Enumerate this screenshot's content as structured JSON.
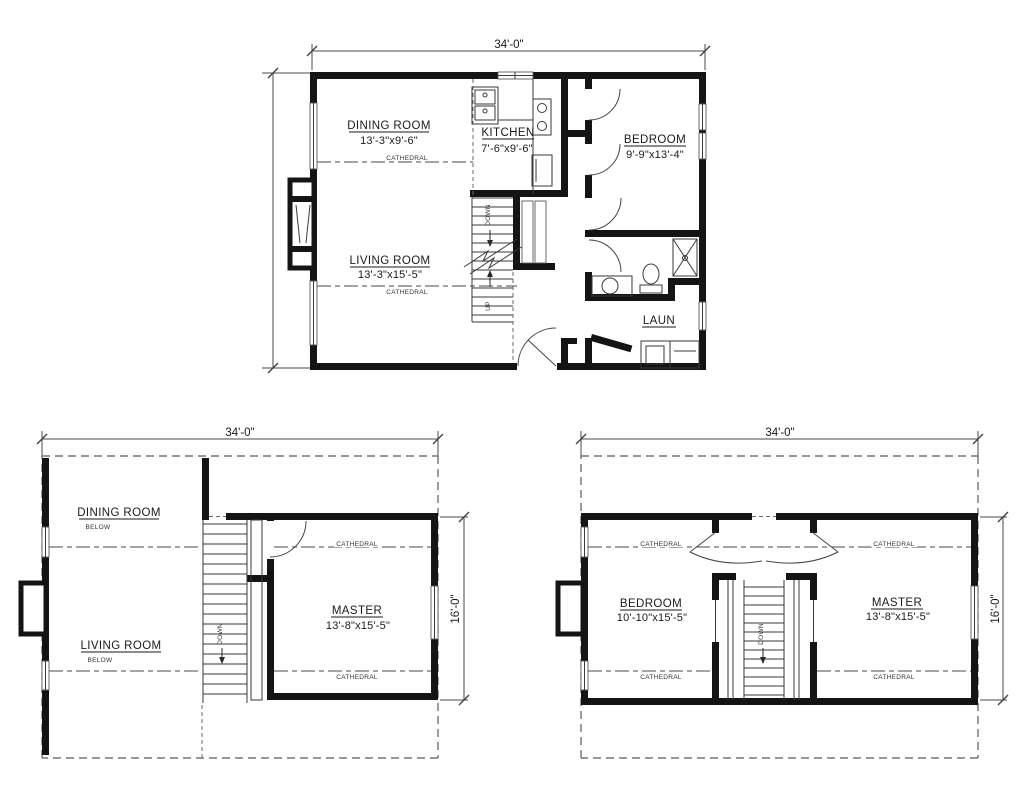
{
  "sheet": {
    "background": "#ffffff",
    "ink": "#141414"
  },
  "plans": {
    "main": {
      "dim_width": "34'-0\"",
      "dim_height": "26'-0\"",
      "rooms": {
        "dining": {
          "name": "DINING ROOM",
          "size": "13'-3\"x9'-6\""
        },
        "kitchen": {
          "name": "KITCHEN",
          "size": "7'-6\"x9'-6\""
        },
        "bedroom": {
          "name": "BEDROOM",
          "size": "9'-9\"x13'-4\""
        },
        "living": {
          "name": "LIVING ROOM",
          "size": "13'-3\"x15'-5\""
        },
        "laundry": {
          "name": "LAUN"
        }
      },
      "notes": {
        "cathedral": "CATHEDRAL",
        "down": "DOWN",
        "up": "UP"
      }
    },
    "upper_a": {
      "dim_width": "34'-0\"",
      "dim_height": "16'-0\"",
      "rooms": {
        "dining": {
          "name": "DINING ROOM",
          "note": "BELOW"
        },
        "living": {
          "name": "LIVING ROOM",
          "note": "BELOW"
        },
        "master": {
          "name": "MASTER",
          "size": "13'-8\"x15'-5\""
        }
      },
      "notes": {
        "cathedral": "CATHEDRAL",
        "down": "DOWN"
      }
    },
    "upper_b": {
      "dim_width": "34'-0\"",
      "dim_height": "16'-0\"",
      "rooms": {
        "bedroom": {
          "name": "BEDROOM",
          "size": "10'-10\"x15'-5\""
        },
        "master": {
          "name": "MASTER",
          "size": "13'-8\"x15'-5\""
        }
      },
      "notes": {
        "cathedral": "CATHEDRAL",
        "down": "DOWN"
      }
    }
  }
}
